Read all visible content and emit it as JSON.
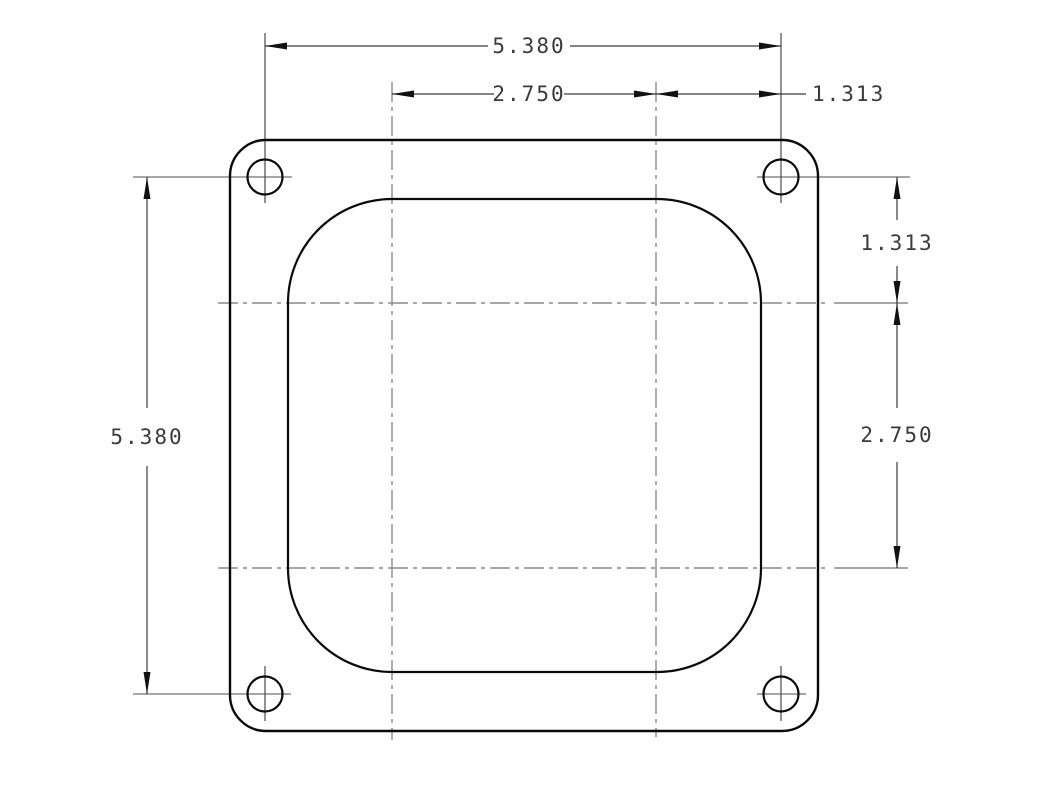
{
  "canvas": {
    "width": 1042,
    "height": 801,
    "background": "#ffffff"
  },
  "colors": {
    "outline": "#0a0a0a",
    "dimension_line": "#3c3c3c",
    "extension_line": "#4a4a4a",
    "centerline": "#8a8a8a",
    "arrow": "#111111",
    "text": "#3a3a3a"
  },
  "dimensions": {
    "top_overall": "5.380",
    "top_center_spacing": "2.750",
    "top_bolt_offset": "1.313",
    "left_overall": "5.380",
    "right_bolt_offset": "1.313",
    "right_center_spacing": "2.750"
  },
  "features": {
    "bolt_hole_count": 4,
    "outer_shape": "rounded-square flange",
    "opening_shape": "rounded-square bore opening"
  }
}
